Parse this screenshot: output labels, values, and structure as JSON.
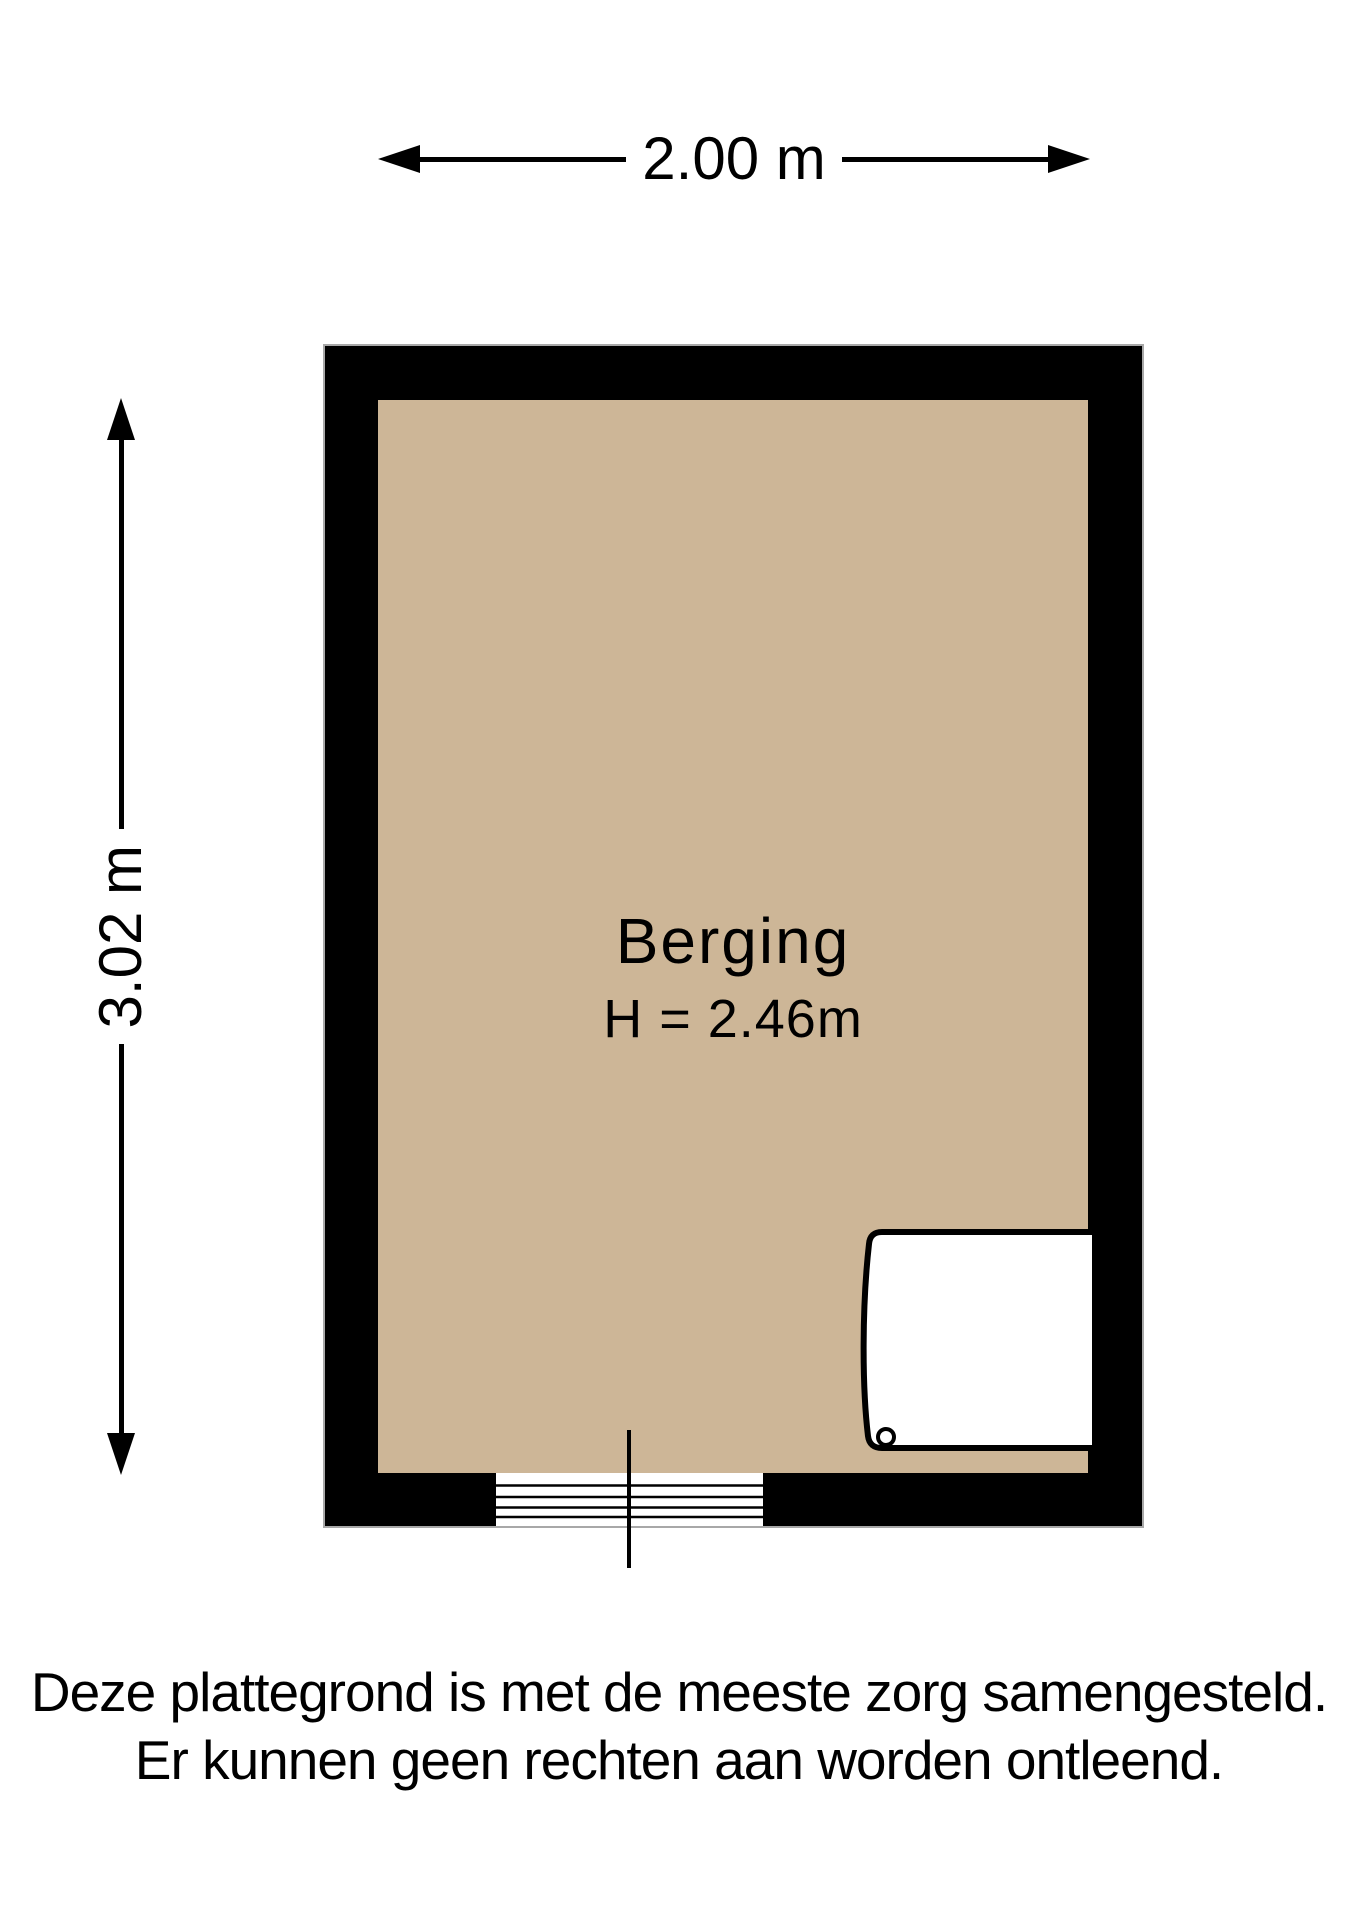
{
  "plan": {
    "type": "floor-plan",
    "room": {
      "name": "Berging",
      "ceiling_height_label": "H = 2.46m"
    },
    "dimensions": {
      "width_label": "2.00 m",
      "depth_label": "3.02 m"
    },
    "colors": {
      "floor": "#cdb697",
      "wall": "#000000",
      "outline": "#a8a8a8",
      "background": "#ffffff"
    }
  },
  "disclaimer": {
    "line1": "Deze plattegrond is met de meeste zorg samengesteld.",
    "line2": "Er kunnen geen rechten aan worden ontleend."
  }
}
